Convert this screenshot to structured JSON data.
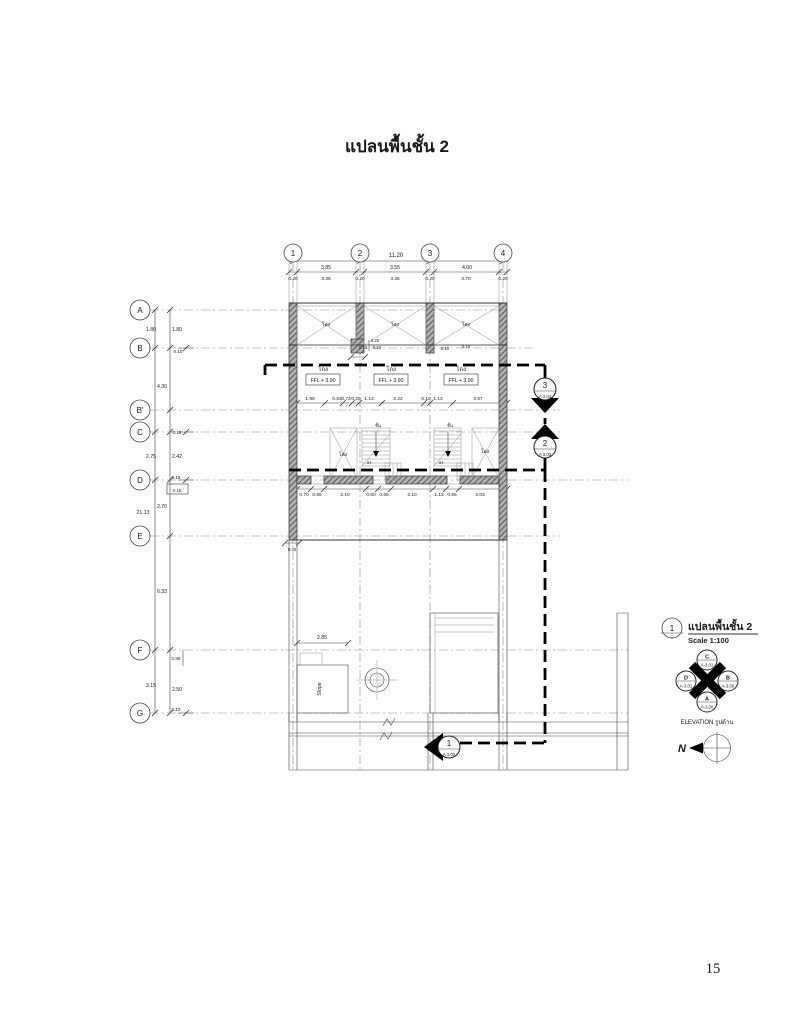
{
  "page": {
    "title": "แปลนพื้นชั้น 2",
    "number": "15"
  },
  "grid": {
    "cols": [
      "1",
      "2",
      "3",
      "4"
    ],
    "rows": [
      "A",
      "B",
      "B'",
      "C",
      "D",
      "E",
      "F",
      "G"
    ]
  },
  "dims": {
    "top_total": "11.20",
    "top_spans": [
      "3.85",
      "3.55",
      "4.00"
    ],
    "top_detail": [
      "0.20",
      "3.36",
      "0.20",
      "3.36",
      "0.20",
      "3.70",
      "0.20"
    ],
    "left": {
      "total": "21.13",
      "ab_outer": "1.80",
      "ab_inner": "1.80",
      "b_offset": "0.10",
      "bb2": "4.30",
      "c_offset": "0.18",
      "cd_outer": "2.75",
      "cd_inner": "2.42",
      "d_offset": "0.15",
      "d_offset_boxed": "0.15",
      "de": "2.70",
      "ef": "6.33",
      "f_offset": "0.85",
      "fg_outer": "3.15",
      "fg_inner": "2.50",
      "g_offset": "0.10"
    },
    "mid_row": [
      "1.99",
      "0.63",
      "0.73",
      "0.20",
      "1.13",
      "2.22",
      "0.10",
      "1.13",
      "2.57"
    ],
    "bottom_row": [
      "0.70",
      "0.65",
      "2.10",
      "0.60",
      "0.65",
      "2.10",
      "1.13",
      "0.65",
      "2.03"
    ],
    "col2_cluster": [
      "0.20",
      "0.10",
      "0.10",
      "0.40"
    ],
    "col3_offset": "0.10",
    "col4_offset": "0.10",
    "wall_foot": "0.40",
    "slope_width": "2.85"
  },
  "labels": {
    "hall": "โถง",
    "void": "โล่ง",
    "ffl": "FFL + 3.90",
    "stair_up": "ขึ้น",
    "stair_down": "ลง",
    "slope": "Slope"
  },
  "sections": {
    "s3": {
      "num": "3",
      "sheet": "A 3.04"
    },
    "s2": {
      "num": "2",
      "sheet": "A 3.03"
    },
    "s1": {
      "num": "1",
      "sheet": "A 3.02"
    }
  },
  "legend": {
    "ref": "1",
    "title": "แปลนพื้นชั้น 2",
    "scale": "Scale 1:100",
    "caption": "ELEVATION รูปด้าน",
    "elev": {
      "top": {
        "letter": "C",
        "sheet": "A-3.01"
      },
      "left": {
        "letter": "D",
        "sheet": "A-3.01"
      },
      "right": {
        "letter": "B",
        "sheet": "A-3.00"
      },
      "bottom": {
        "letter": "A",
        "sheet": "A-3.00"
      }
    },
    "north": "N"
  },
  "colors": {
    "ink": "#1a1a1a",
    "wall_fill": "#b3b3b3",
    "section_line": "#000000"
  }
}
